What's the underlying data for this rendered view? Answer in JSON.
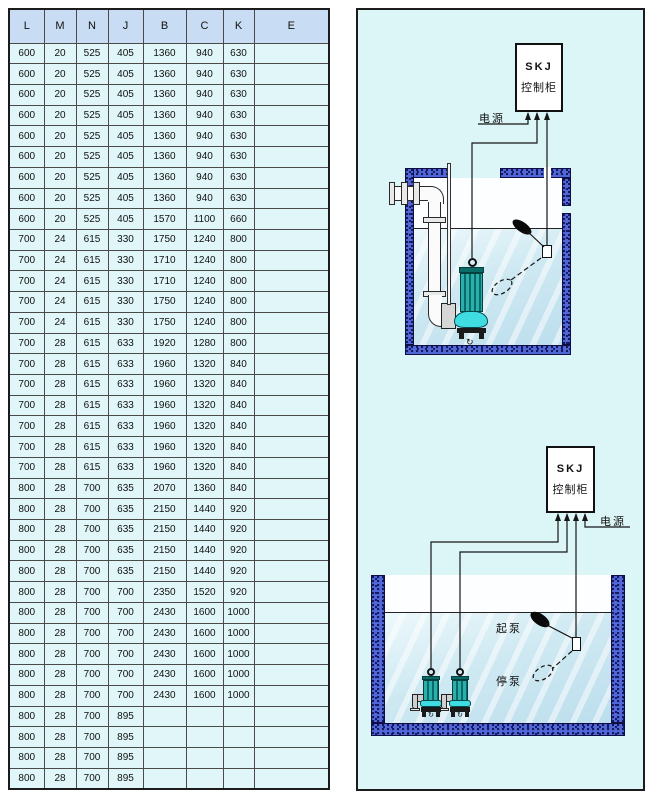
{
  "table": {
    "headers": [
      "L",
      "M",
      "N",
      "J",
      "B",
      "C",
      "K",
      "E"
    ],
    "rows": [
      [
        "600",
        "20",
        "525",
        "405",
        "1360",
        "940",
        "630",
        ""
      ],
      [
        "600",
        "20",
        "525",
        "405",
        "1360",
        "940",
        "630",
        ""
      ],
      [
        "600",
        "20",
        "525",
        "405",
        "1360",
        "940",
        "630",
        ""
      ],
      [
        "600",
        "20",
        "525",
        "405",
        "1360",
        "940",
        "630",
        ""
      ],
      [
        "600",
        "20",
        "525",
        "405",
        "1360",
        "940",
        "630",
        ""
      ],
      [
        "600",
        "20",
        "525",
        "405",
        "1360",
        "940",
        "630",
        ""
      ],
      [
        "600",
        "20",
        "525",
        "405",
        "1360",
        "940",
        "630",
        ""
      ],
      [
        "600",
        "20",
        "525",
        "405",
        "1360",
        "940",
        "630",
        ""
      ],
      [
        "600",
        "20",
        "525",
        "405",
        "1570",
        "1100",
        "660",
        ""
      ],
      [
        "700",
        "24",
        "615",
        "330",
        "1750",
        "1240",
        "800",
        ""
      ],
      [
        "700",
        "24",
        "615",
        "330",
        "1710",
        "1240",
        "800",
        ""
      ],
      [
        "700",
        "24",
        "615",
        "330",
        "1710",
        "1240",
        "800",
        ""
      ],
      [
        "700",
        "24",
        "615",
        "330",
        "1750",
        "1240",
        "800",
        ""
      ],
      [
        "700",
        "24",
        "615",
        "330",
        "1750",
        "1240",
        "800",
        ""
      ],
      [
        "700",
        "28",
        "615",
        "633",
        "1920",
        "1280",
        "800",
        ""
      ],
      [
        "700",
        "28",
        "615",
        "633",
        "1960",
        "1320",
        "840",
        ""
      ],
      [
        "700",
        "28",
        "615",
        "633",
        "1960",
        "1320",
        "840",
        ""
      ],
      [
        "700",
        "28",
        "615",
        "633",
        "1960",
        "1320",
        "840",
        ""
      ],
      [
        "700",
        "28",
        "615",
        "633",
        "1960",
        "1320",
        "840",
        ""
      ],
      [
        "700",
        "28",
        "615",
        "633",
        "1960",
        "1320",
        "840",
        ""
      ],
      [
        "700",
        "28",
        "615",
        "633",
        "1960",
        "1320",
        "840",
        ""
      ],
      [
        "800",
        "28",
        "700",
        "635",
        "2070",
        "1360",
        "840",
        ""
      ],
      [
        "800",
        "28",
        "700",
        "635",
        "2150",
        "1440",
        "920",
        ""
      ],
      [
        "800",
        "28",
        "700",
        "635",
        "2150",
        "1440",
        "920",
        ""
      ],
      [
        "800",
        "28",
        "700",
        "635",
        "2150",
        "1440",
        "920",
        ""
      ],
      [
        "800",
        "28",
        "700",
        "635",
        "2150",
        "1440",
        "920",
        ""
      ],
      [
        "800",
        "28",
        "700",
        "700",
        "2350",
        "1520",
        "920",
        ""
      ],
      [
        "800",
        "28",
        "700",
        "700",
        "2430",
        "1600",
        "1000",
        ""
      ],
      [
        "800",
        "28",
        "700",
        "700",
        "2430",
        "1600",
        "1000",
        ""
      ],
      [
        "800",
        "28",
        "700",
        "700",
        "2430",
        "1600",
        "1000",
        ""
      ],
      [
        "800",
        "28",
        "700",
        "700",
        "2430",
        "1600",
        "1000",
        ""
      ],
      [
        "800",
        "28",
        "700",
        "700",
        "2430",
        "1600",
        "1000",
        ""
      ],
      [
        "800",
        "28",
        "700",
        "895",
        "",
        "",
        "",
        ""
      ],
      [
        "800",
        "28",
        "700",
        "895",
        "",
        "",
        "",
        ""
      ],
      [
        "800",
        "28",
        "700",
        "895",
        "",
        "",
        "",
        ""
      ],
      [
        "800",
        "28",
        "700",
        "895",
        "",
        "",
        "",
        ""
      ]
    ]
  },
  "diagram": {
    "cabinet": {
      "model": "SKJ",
      "name": "控制柜"
    },
    "power_label": "电源",
    "start_pump_label": "起泵",
    "stop_pump_label": "停泵",
    "swirl_icon": "↻"
  },
  "colors": {
    "panel_bg": "#dcf5f6",
    "wall_blue": "#5067d8",
    "wall_speckle": "#141457",
    "pump_teal": "#2ab0ac",
    "pump_teal_dark": "#0b6b68",
    "pump_cyan": "#3fdde2",
    "header_bg": "#c8ddf3",
    "cell_bg": "#e1f6f8",
    "line": "#1c1c1c"
  }
}
